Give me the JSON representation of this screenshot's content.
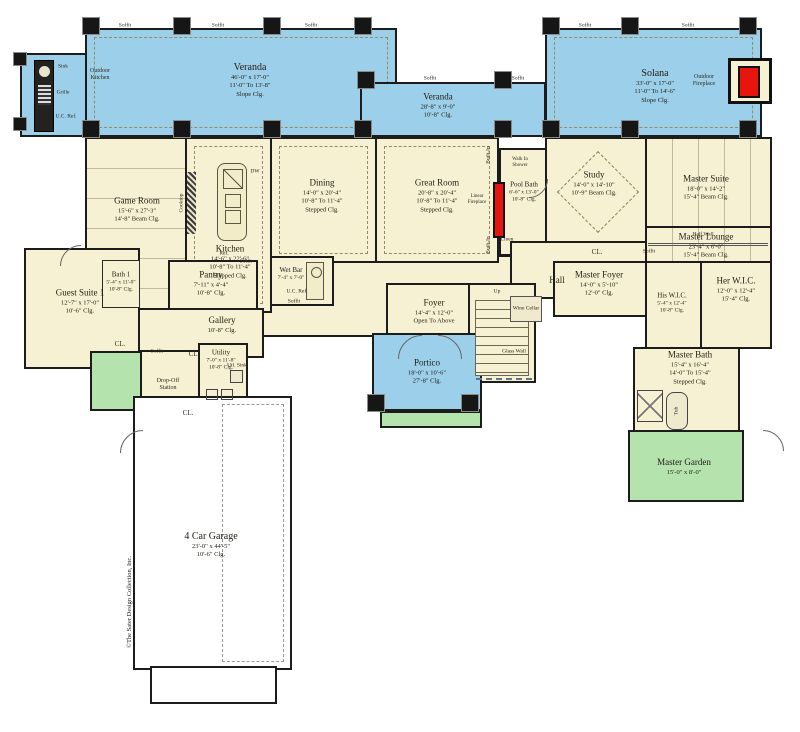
{
  "colors": {
    "veranda_blue": "#9ccfe9",
    "floor_cream": "#f7f1d3",
    "garden_green": "#b5e3ad",
    "wall_black": "#1c1c1c",
    "fireplace_red": "#e8150f",
    "garage_white": "#ffffff"
  },
  "rooms": {
    "veranda_left": {
      "name": "Veranda",
      "l1": "46'-0\" x 17'-0\"",
      "l2": "11'-0\" To 13'-8\"",
      "l3": "Slope Clg."
    },
    "veranda_mid": {
      "name": "Veranda",
      "l1": "28'-8\" x 9'-0\"",
      "l2": "10'-8\"  Clg."
    },
    "solana": {
      "name": "Solana",
      "l1": "33'-0\" x 17'-0\"",
      "l2": "11'-0\" To 14'-6\"",
      "l3": "Slope Clg."
    },
    "game_room": {
      "name": "Game Room",
      "l1": "15'-6\" x 27'-3\"",
      "l2": "14'-8\" Beam Clg."
    },
    "kitchen": {
      "name": "Kitchen",
      "l1": "14'-6\" x 22'-6\"",
      "l2": "10'-8\" To 11'-4\"",
      "l3": "Stepped Clg."
    },
    "dining": {
      "name": "Dining",
      "l1": "14'-0\" x 20'-4\"",
      "l2": "10'-8\" To 11'-4\"",
      "l3": "Stepped Clg."
    },
    "great_room": {
      "name": "Great Room",
      "l1": "20'-8\" x 20'-4\"",
      "l2": "10'-8\" To 11'-4\"",
      "l3": "Stepped Clg."
    },
    "study": {
      "name": "Study",
      "l1": "14'-0\" x 14'-10\"",
      "l2": "10'-9\" Beam Clg."
    },
    "pool_bath": {
      "name": "Pool Bath",
      "l1": "6'-6\" x 13'-0\"",
      "l2": "10'-8\" Clg."
    },
    "master_suite": {
      "name": "Master Suite",
      "l1": "18'-0\" x 14'-2\"",
      "l2": "15'-4\" Beam Clg."
    },
    "master_lounge": {
      "name": "Master Lounge",
      "l1": "23'-4\" x 6'-0\"",
      "l2": "15'-4\" Beam Clg."
    },
    "hall": {
      "name": "Hall"
    },
    "master_foyer": {
      "name": "Master Foyer",
      "l1": "14'-0\" x 5'-10\"",
      "l2": "12'-0\" Clg."
    },
    "his_wic": {
      "name": "His W.I.C.",
      "l1": "5'-4\" x 12'-4\"",
      "l2": "10'-8\" Clg."
    },
    "her_wic": {
      "name": "Her W.I.C.",
      "l1": "12'-0\" x 12'-4\"",
      "l2": "15'-4\" Clg."
    },
    "master_bath": {
      "name": "Master Bath",
      "l1": "15'-4\" x 16'-4\"",
      "l2": "14'-0\" To 15'-4\"",
      "l3": "Stepped Clg."
    },
    "master_garden": {
      "name": "Master Garden",
      "l1": "15'-0\" x 8'-0\""
    },
    "guest_suite": {
      "name": "Guest Suite 1",
      "l1": "12'-7\" x 17'-0\"",
      "l2": "10'-6\" Clg."
    },
    "bath1": {
      "name": "Bath 1",
      "l1": "5'-4\" x 11'-0\"",
      "l2": "10'-8\" Clg."
    },
    "pantry": {
      "name": "Pantry",
      "l1": "7'-11\" x 4'-4\"",
      "l2": "10'-8\" Clg."
    },
    "gallery": {
      "name": "Gallery",
      "l1": "10'-8\" Clg."
    },
    "wet_bar": {
      "name": "Wet Bar",
      "l1": "7'-4\" x 7'-0\""
    },
    "foyer": {
      "name": "Foyer",
      "l1": "14'-4\" x 12'-0\"",
      "l2": "Open To Above"
    },
    "portico": {
      "name": "Portico",
      "l1": "18'-0\" x 10'-6\"",
      "l2": "27'-8\"  Clg."
    },
    "utility": {
      "name": "Utility",
      "l1": "7'-0\" x 11'-8\"",
      "l2": "10'-8\" Clg."
    },
    "garage": {
      "name": "4 Car Garage",
      "l1": "23'-0\" x 44'-5\"",
      "l2": "10'-6\" Clg."
    }
  },
  "labels": {
    "soffit": "Soffit",
    "cl": "CL.",
    "linen": "Linen",
    "built_in": "Built-In",
    "half_wall": "Half Wall",
    "glass_wall": "Glass Wall",
    "wine_cellar": "Wine Cellar",
    "up": "Up",
    "dw": "DW",
    "ref": "Ref.",
    "cooktop": "Cooktop",
    "utl_sink": "Utl. Sink",
    "tub": "Tub",
    "sink": "Sink",
    "grille": "Grille",
    "uc_ref": "U.C. Ref.",
    "drop_off_1": "Drop-Off",
    "drop_off_2": "Station",
    "walk_in_shower_1": "Walk In",
    "walk_in_shower_2": "Shower",
    "outdoor_kitchen_1": "Outdoor",
    "outdoor_kitchen_2": "Kitchen",
    "outdoor_fireplace_1": "Outdoor",
    "outdoor_fireplace_2": "Fireplace",
    "linear_fireplace_1": "Linear",
    "linear_fireplace_2": "Fireplace",
    "copyright": "©The Sater Design Collection, Inc."
  }
}
